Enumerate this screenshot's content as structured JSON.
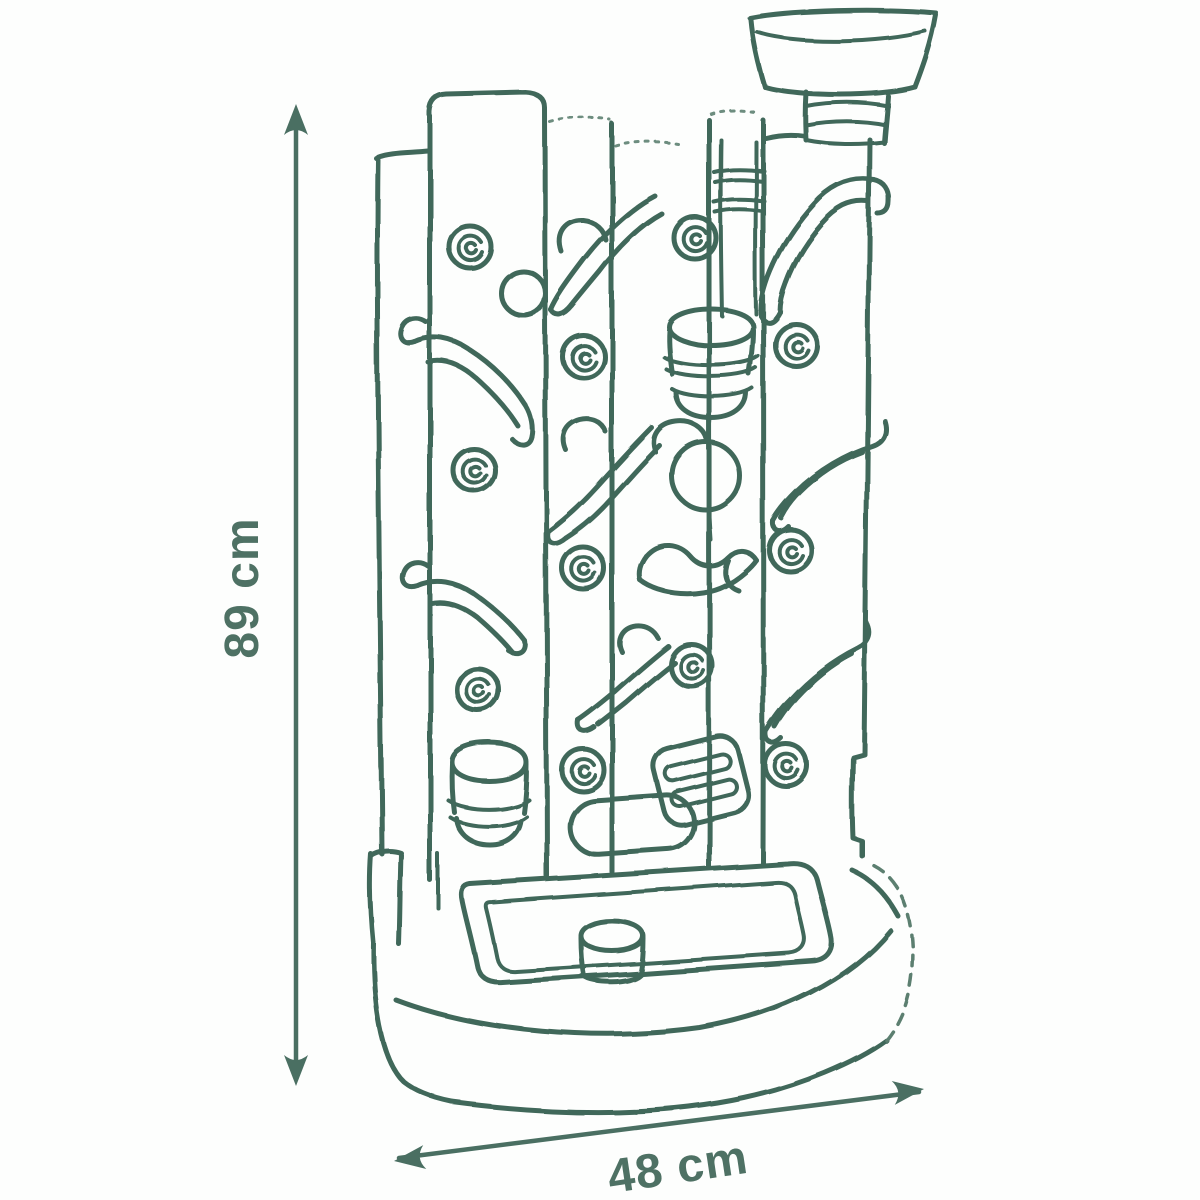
{
  "page": {
    "background": "#ffffff"
  },
  "sketch": {
    "ink_color": "#41685a"
  },
  "dimensions": {
    "height_label": "89 cm",
    "width_label": "48 cm",
    "label_color": "#4e7164",
    "arrow_color": "#4a6f62"
  }
}
